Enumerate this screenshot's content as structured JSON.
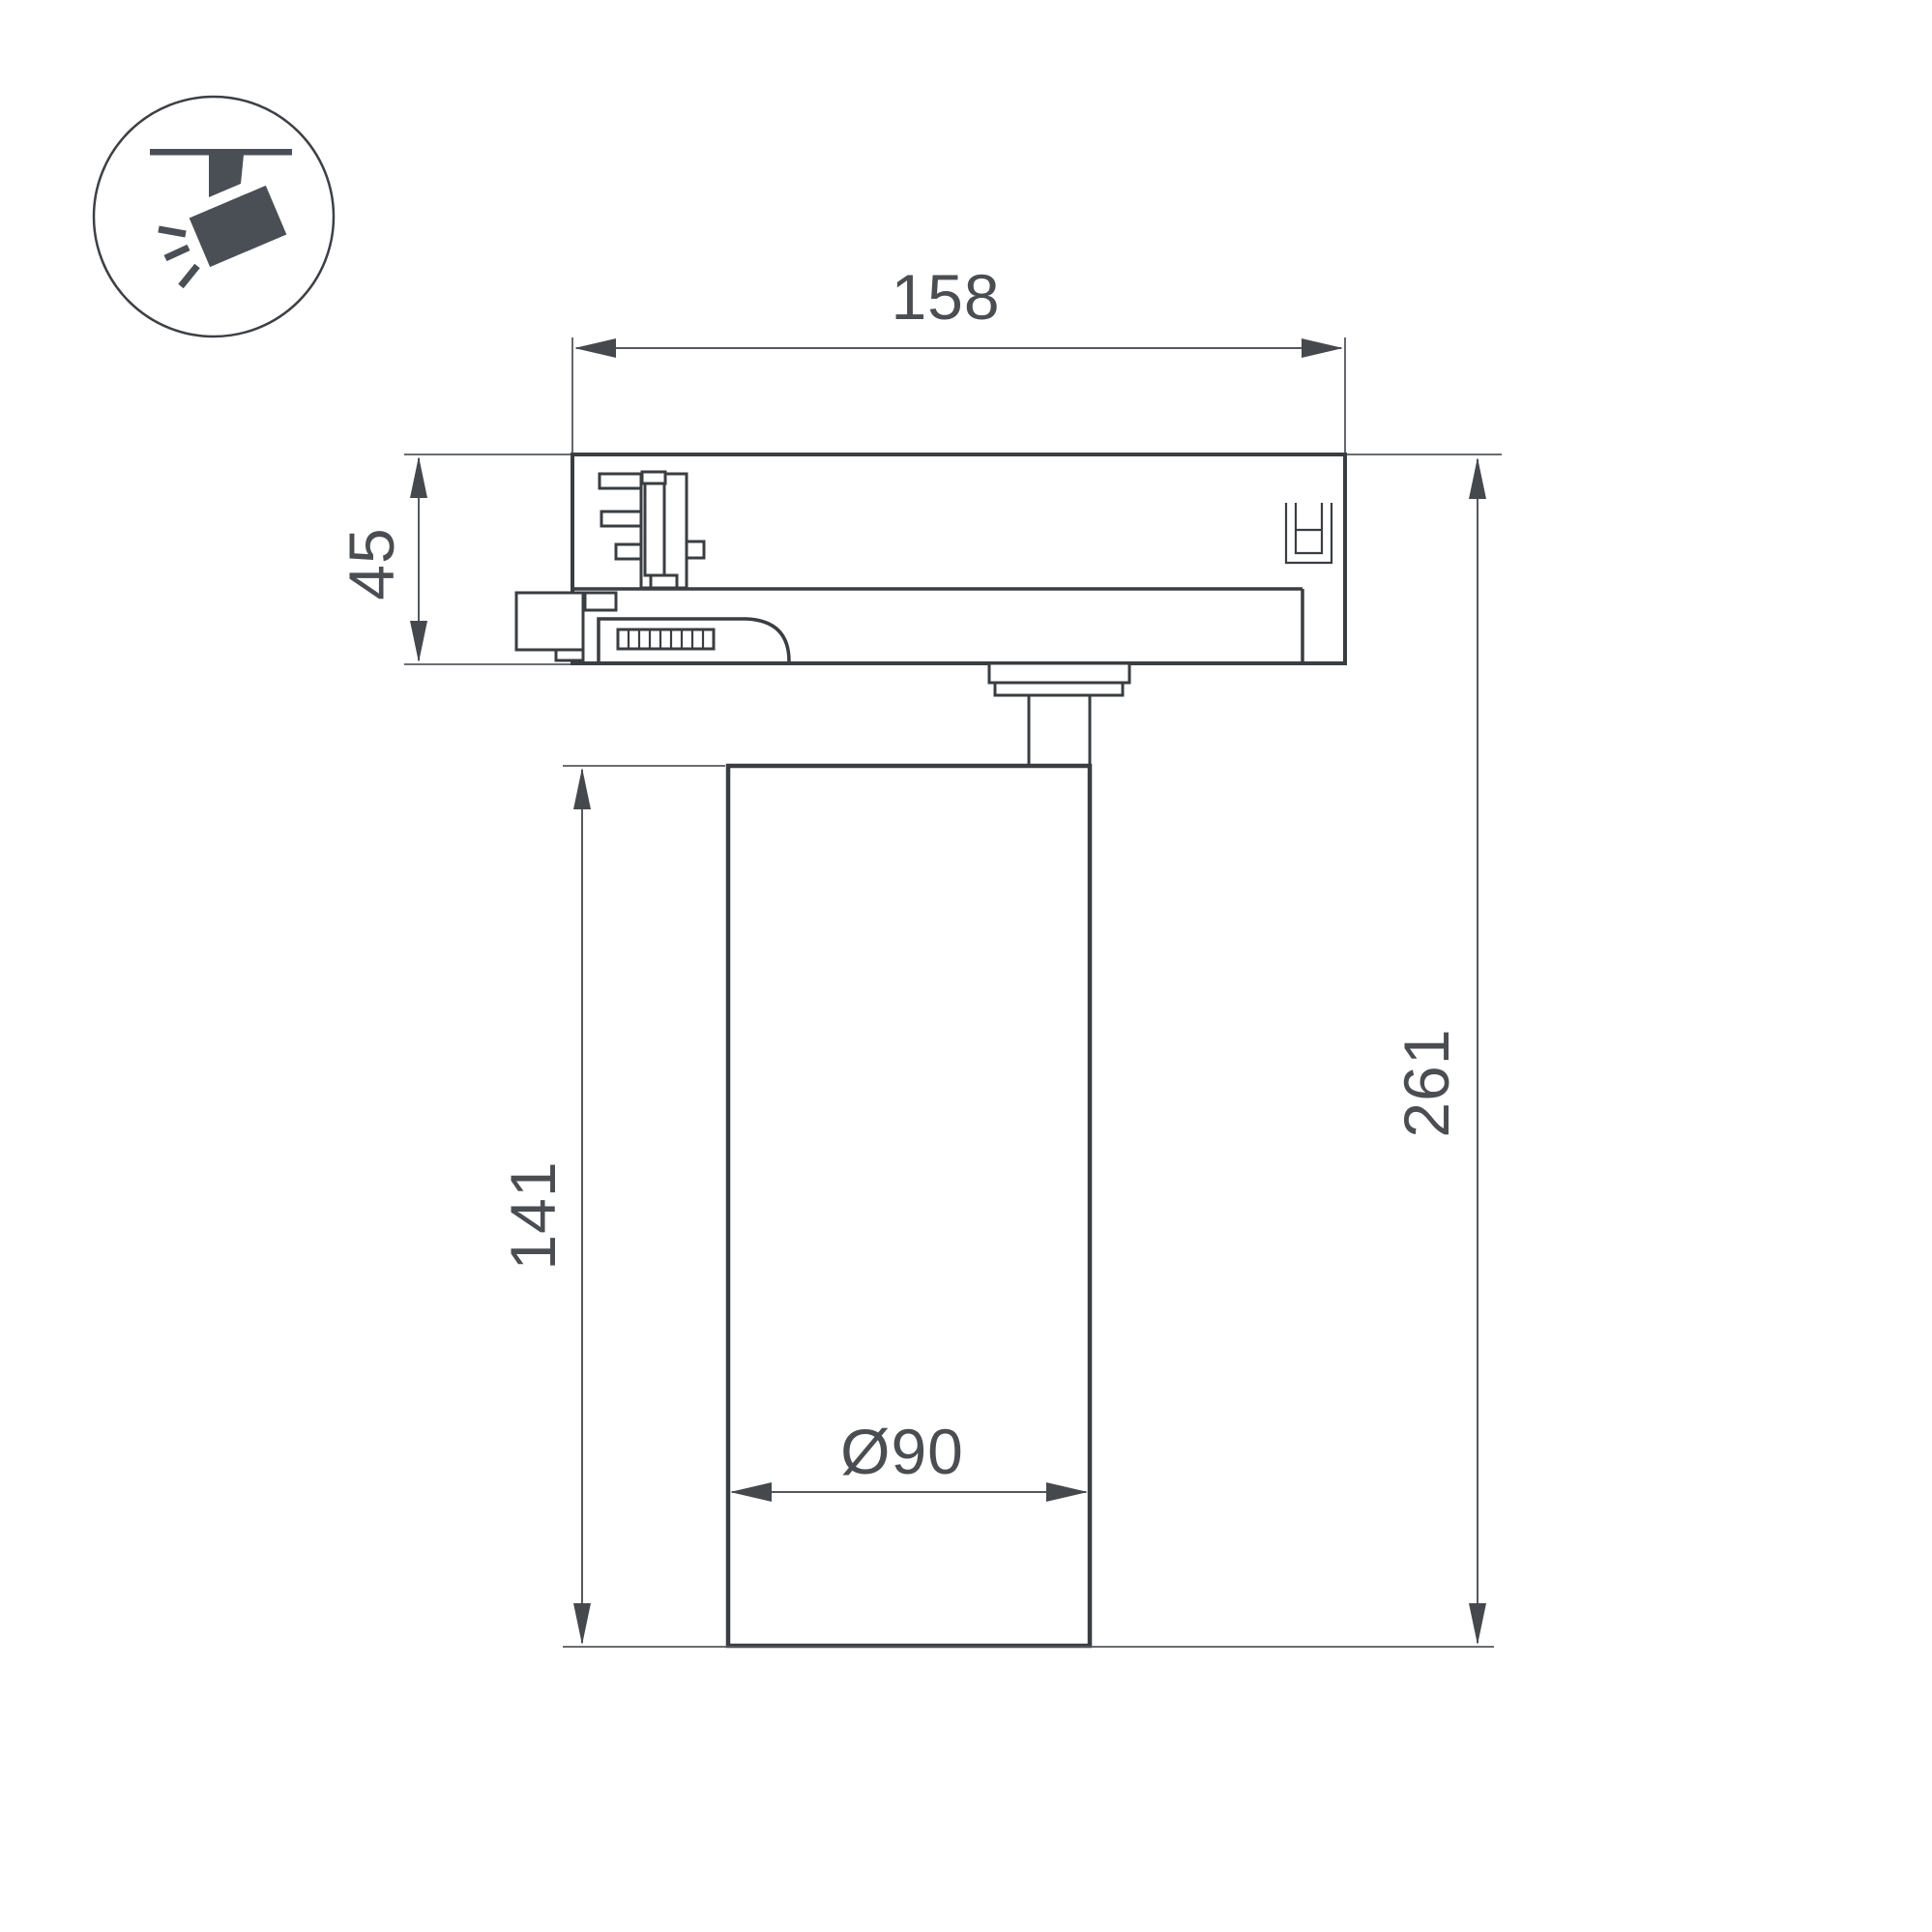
{
  "theme": {
    "bg": "#ffffff",
    "line": "#3a3d41",
    "thin": "#55585c",
    "arrow": "#45484d",
    "text": "#4a4d52",
    "icon": "#4a4f55"
  },
  "icon": {
    "name": "track-spotlight-icon"
  },
  "dimensions": {
    "width_top": "158",
    "adapter_height": "45",
    "body_height": "141",
    "total_height": "261",
    "body_diameter": "Ø90"
  }
}
